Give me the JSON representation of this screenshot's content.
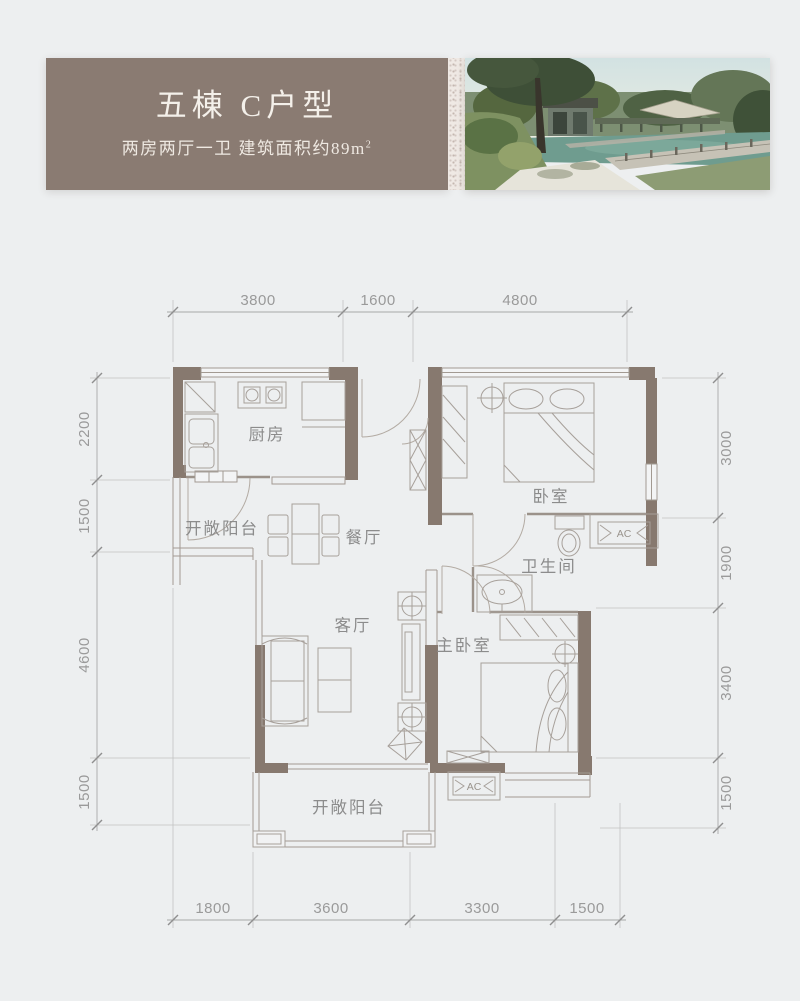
{
  "header": {
    "title": "五棟 C户型",
    "subtitle": "两房两厅一卫 建筑面积约89m",
    "subtitle_sup": "2"
  },
  "floorplan": {
    "rooms": {
      "kitchen": "厨房",
      "balcony_top": "开敞阳台",
      "dining": "餐厅",
      "bedroom": "卧室",
      "bathroom": "卫生间",
      "living": "客厅",
      "master_bedroom": "主卧室",
      "balcony_bottom": "开敞阳台"
    },
    "ac_top": "AC",
    "ac_bottom": "AC",
    "dims": {
      "top": [
        "3800",
        "1600",
        "4800"
      ],
      "bottom": [
        "1800",
        "3600",
        "3300",
        "1500"
      ],
      "left": [
        "2200",
        "1500",
        "4600",
        "1500"
      ],
      "right": [
        "3000",
        "1900",
        "3400",
        "1500"
      ]
    },
    "colors": {
      "wall": "#87796f",
      "header_box": "#8a7b72",
      "dim_text": "#9a9a9a",
      "room_label": "#8c8c8c",
      "background": "#edeff0"
    }
  }
}
